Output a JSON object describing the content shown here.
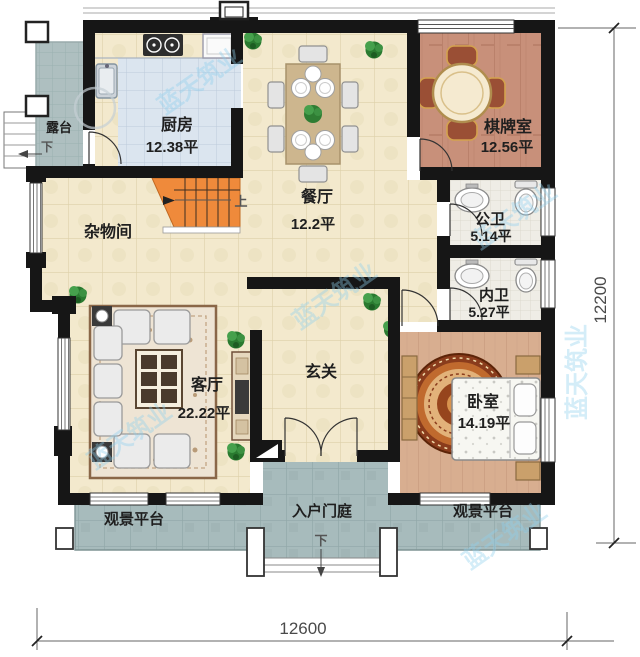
{
  "title": "residential floor plan",
  "rooms": {
    "terrace": {
      "name": "露台"
    },
    "kitchen": {
      "name": "厨房",
      "area": "12.38平"
    },
    "dining": {
      "name": "餐厅",
      "area": "12.2平"
    },
    "chess_room": {
      "name": "棋牌室",
      "area": "12.56平"
    },
    "public_bath": {
      "name": "公卫",
      "area": "5.14平"
    },
    "private_bath": {
      "name": "内卫",
      "area": "5.27平"
    },
    "storage": {
      "name": "杂物间"
    },
    "living_room": {
      "name": "客厅",
      "area": "22.22平"
    },
    "foyer": {
      "name": "玄关"
    },
    "bedroom": {
      "name": "卧室",
      "area": "14.19平"
    },
    "view_platform_left": {
      "name": "观景平台"
    },
    "entry_court": {
      "name": "入户门庭"
    },
    "view_platform_right": {
      "name": "观景平台"
    }
  },
  "stairs": {
    "up": "上",
    "down_terrace": "下",
    "down_entry": "下"
  },
  "dimensions": {
    "bottom": "12600",
    "right": "12200"
  },
  "watermark": {
    "text": "蓝天筑业"
  },
  "colors": {
    "wall": "#161616",
    "stairs_orange": "#ef8a3b",
    "beige_tile": "#f3e9cd",
    "grey_tile": "#a7bbbc",
    "kitchen_floor": "#dbe5ef",
    "wood_chess": "#c8907a",
    "wood_bedroom": "#d8ae90",
    "bath_tile": "#efede6",
    "watermark_blue": "#8fd0ee"
  }
}
